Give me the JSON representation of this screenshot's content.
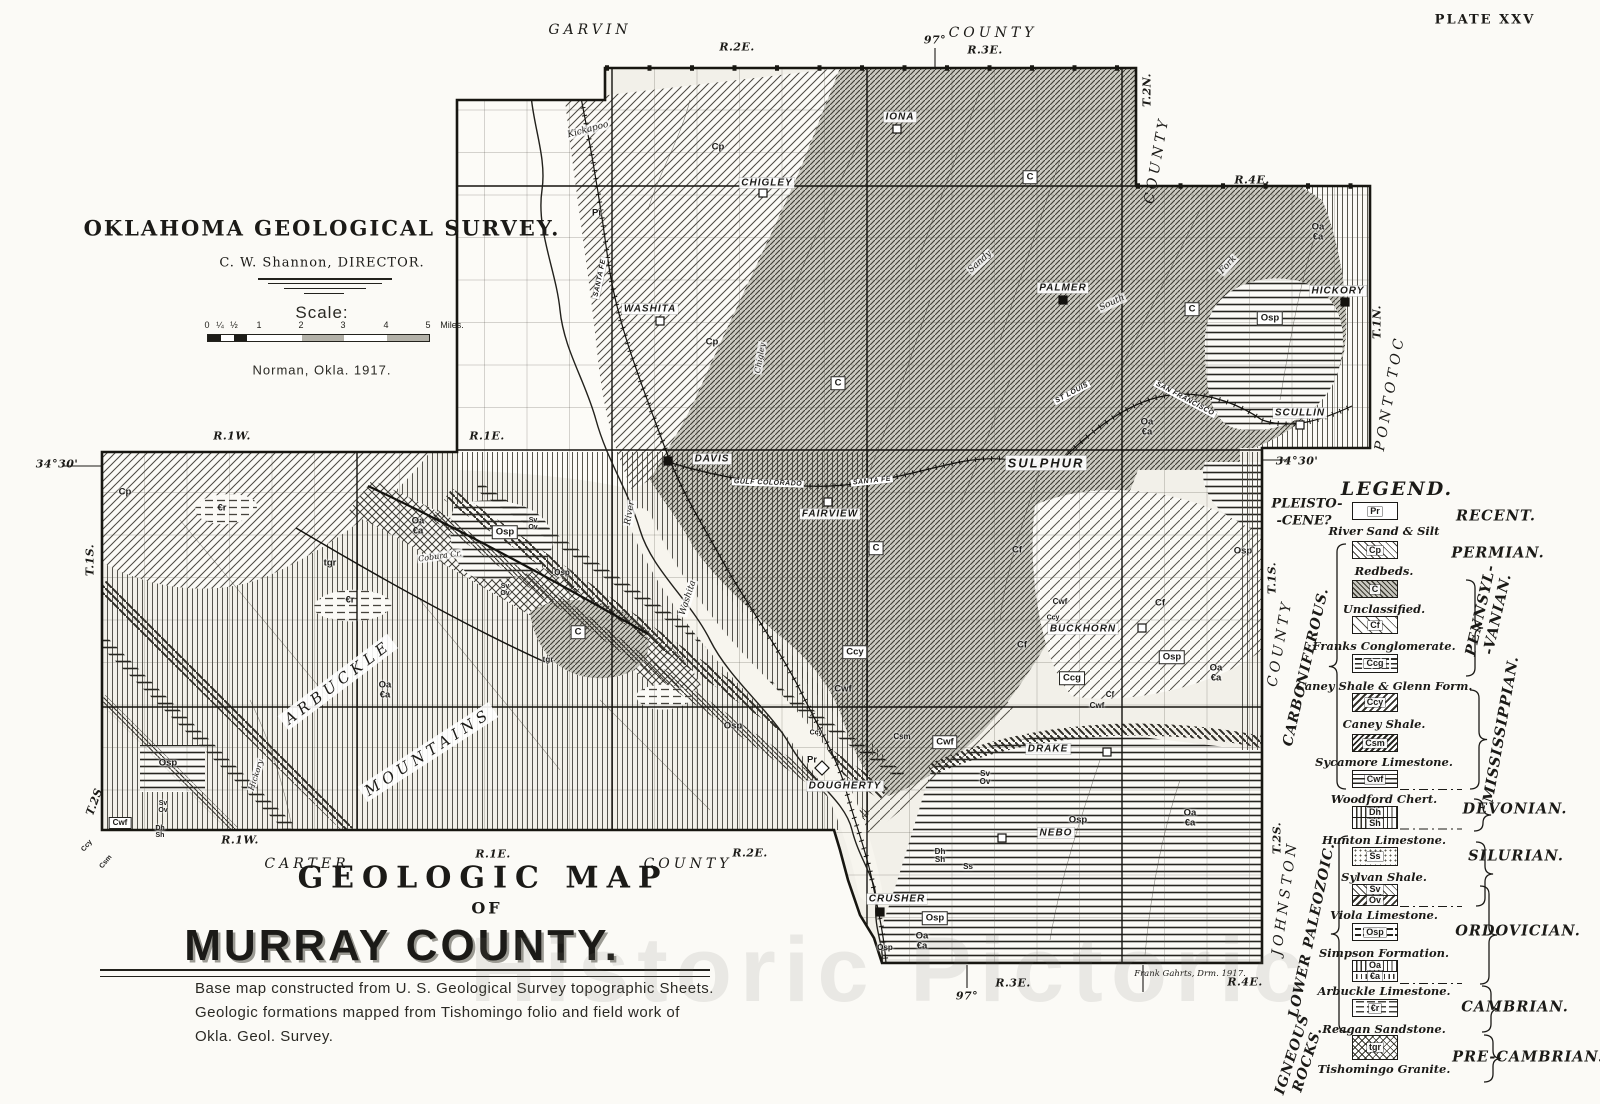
{
  "plate": "PLATE XXV",
  "header": {
    "agency": "OKLAHOMA GEOLOGICAL SURVEY.",
    "director": "C. W. Shannon, DIRECTOR.",
    "scale_label": "Scale:",
    "scale_ticks": [
      "0",
      "¼",
      "½",
      "1",
      "2",
      "3",
      "4",
      "5"
    ],
    "scale_unit": "Miles.",
    "place_date": "Norman, Okla. 1917."
  },
  "footer": {
    "title_line1": "GEOLOGIC MAP",
    "title_line2": "OF",
    "title_line3": "MURRAY COUNTY.",
    "caption_line1": "Base map constructed from U. S. Geological Survey topographic Sheets.",
    "caption_line2": "Geologic formations mapped from Tishomingo folio and field work of",
    "caption_line3": "Okla. Geol. Survey.",
    "credit": "Frank Gahrts, Drm. 1917."
  },
  "watermark": "Historic Pictoric",
  "legend": {
    "title": "LEGEND.",
    "era_left": [
      "PLEISTO-",
      "-CENE?"
    ],
    "rows": [
      {
        "codes": [
          "Pr"
        ],
        "pattern": [
          "blank"
        ],
        "name": "River Sand & Silt",
        "y": 502,
        "h": 18,
        "ny": 531
      },
      {
        "codes": [
          "Cp"
        ],
        "pattern": [
          "diag"
        ],
        "name": "Redbeds.",
        "y": 541,
        "h": 18,
        "ny": 571
      },
      {
        "codes": [
          "C"
        ],
        "pattern": [
          "diagdark"
        ],
        "name": "Unclassified.",
        "y": 580,
        "h": 18,
        "ny": 609
      },
      {
        "codes": [
          "Cf"
        ],
        "pattern": [
          "diagsparse"
        ],
        "name": "Franks Conglomerate.",
        "y": 616,
        "h": 18,
        "ny": 646
      },
      {
        "codes": [
          "Ccg"
        ],
        "pattern": [
          "brick"
        ],
        "name": "Caney Shale & Glenn Form.",
        "y": 654,
        "h": 19,
        "ny": 686
      },
      {
        "codes": [
          "Ccy"
        ],
        "pattern": [
          "chevron"
        ],
        "name": "Caney Shale.",
        "y": 693,
        "h": 19,
        "ny": 724
      },
      {
        "codes": [
          "Csm"
        ],
        "pattern": [
          "diag2"
        ],
        "name": "Sycamore Limestone.",
        "y": 734,
        "h": 18,
        "ny": 762
      },
      {
        "codes": [
          "Cwf"
        ],
        "pattern": [
          "horiz"
        ],
        "name": "Woodford Chert.",
        "y": 770,
        "h": 18,
        "ny": 799
      },
      {
        "codes": [
          "Dh",
          "Sh"
        ],
        "pattern": [
          "vert",
          "vert"
        ],
        "name": "Hunton Limestone.",
        "y": 806,
        "h": 23,
        "ny": 840
      },
      {
        "codes": [
          "Ss"
        ],
        "pattern": [
          "stipple"
        ],
        "name": "Sylvan Shale.",
        "y": 847,
        "h": 19,
        "ny": 877
      },
      {
        "codes": [
          "Sv",
          "Ov"
        ],
        "pattern": [
          "diag",
          "chevron"
        ],
        "name": "Viola Limestone.",
        "y": 884,
        "h": 22,
        "ny": 915
      },
      {
        "codes": [
          "Osp"
        ],
        "pattern": [
          "horizdash"
        ],
        "name": "Simpson Formation.",
        "y": 923,
        "h": 18,
        "ny": 953
      },
      {
        "codes": [
          "Oa",
          "€a"
        ],
        "pattern": [
          "vert",
          "vertdash"
        ],
        "name": "Arbuckle Limestone.",
        "y": 960,
        "h": 22,
        "ny": 991
      },
      {
        "codes": [
          "€r"
        ],
        "pattern": [
          "dash"
        ],
        "name": "Reagan Sandstone.",
        "y": 999,
        "h": 18,
        "ny": 1029
      },
      {
        "codes": [
          "tgr"
        ],
        "pattern": [
          "cross"
        ],
        "name": "Tishomingo Granite.",
        "y": 1035,
        "h": 25,
        "ny": 1069
      }
    ],
    "periods": [
      {
        "t": "RECENT.",
        "x": 1496,
        "y": 516
      },
      {
        "t": "PERMIAN.",
        "x": 1498,
        "y": 553
      },
      {
        "t": "PENNSYL-|-VANIAN.",
        "x": 1489,
        "y": 612,
        "r": -77
      },
      {
        "t": "MISSISSIPPIAN.",
        "x": 1501,
        "y": 729,
        "r": -80
      },
      {
        "t": "DEVONIAN.",
        "x": 1515,
        "y": 809
      },
      {
        "t": "SILURIAN.",
        "x": 1516,
        "y": 856
      },
      {
        "t": "ORDOVICIAN.",
        "x": 1518,
        "y": 931
      },
      {
        "t": "CAMBRIAN.",
        "x": 1515,
        "y": 1007
      },
      {
        "t": "PRE-CAMBRIAN.",
        "x": 1528,
        "y": 1057
      }
    ],
    "groups": [
      {
        "t": "CARBONIFEROUS.",
        "x": 1306,
        "y": 667,
        "r": -77
      },
      {
        "t": "LOWER PALEOZOIC.",
        "x": 1312,
        "y": 930,
        "r": -78
      },
      {
        "t": "IGNEOUS|ROCKS.",
        "x": 1300,
        "y": 1057,
        "r": -72
      }
    ]
  },
  "map": {
    "edge_labels": [
      {
        "t": "R.2E.",
        "x": 737,
        "y": 47
      },
      {
        "t": "97°",
        "x": 935,
        "y": 40
      },
      {
        "t": "R.3E.",
        "x": 985,
        "y": 50
      },
      {
        "t": "T.2N.",
        "x": 1147,
        "y": 90,
        "r": -90
      },
      {
        "t": "R.4E.",
        "x": 1252,
        "y": 180
      },
      {
        "t": "T.1N.",
        "x": 1377,
        "y": 322,
        "r": -90
      },
      {
        "t": "R.1W.",
        "x": 232,
        "y": 436
      },
      {
        "t": "R.1E.",
        "x": 487,
        "y": 436
      },
      {
        "t": "34°30'",
        "x": 57,
        "y": 464
      },
      {
        "t": "34°30'",
        "x": 1297,
        "y": 461
      },
      {
        "t": "T.1S.",
        "x": 90,
        "y": 560,
        "r": -90
      },
      {
        "t": "T.1S.",
        "x": 1272,
        "y": 578,
        "r": -90
      },
      {
        "t": "T.2S.",
        "x": 95,
        "y": 800,
        "r": -70
      },
      {
        "t": "T.2S.",
        "x": 1277,
        "y": 838,
        "r": -90
      },
      {
        "t": "R.1W.",
        "x": 240,
        "y": 840
      },
      {
        "t": "R.1E.",
        "x": 493,
        "y": 854
      },
      {
        "t": "R.2E.",
        "x": 750,
        "y": 853
      },
      {
        "t": "97°",
        "x": 967,
        "y": 996
      },
      {
        "t": "R.3E.",
        "x": 1013,
        "y": 983
      },
      {
        "t": "R.4E.",
        "x": 1245,
        "y": 982
      }
    ],
    "counties": [
      {
        "t": "GARVIN",
        "x": 590,
        "y": 30
      },
      {
        "t": "COUNTY",
        "x": 993,
        "y": 33
      },
      {
        "t": "COUNTY",
        "x": 1157,
        "y": 160,
        "r": -80
      },
      {
        "t": "PONTOTOC",
        "x": 1390,
        "y": 393,
        "r": -80
      },
      {
        "t": "CARTER",
        "x": 307,
        "y": 864
      },
      {
        "t": "COUNTY",
        "x": 688,
        "y": 864
      },
      {
        "t": "COUNTY",
        "x": 1280,
        "y": 643,
        "r": -80
      },
      {
        "t": "JOHNSTON",
        "x": 1285,
        "y": 898,
        "r": -82
      }
    ],
    "towns": [
      {
        "t": "IONA",
        "x": 900,
        "y": 117
      },
      {
        "t": "CHIGLEY",
        "x": 767,
        "y": 183
      },
      {
        "t": "WASHITA",
        "x": 650,
        "y": 309
      },
      {
        "t": "PALMER",
        "x": 1063,
        "y": 288
      },
      {
        "t": "HICKORY",
        "x": 1338,
        "y": 291
      },
      {
        "t": "SCULLIN",
        "x": 1300,
        "y": 413
      },
      {
        "t": "DAVIS",
        "x": 712,
        "y": 459
      },
      {
        "t": "FAIRVIEW",
        "x": 830,
        "y": 514
      },
      {
        "t": "SULPHUR",
        "x": 1046,
        "y": 463,
        "c": "big"
      },
      {
        "t": "BUCKHORN",
        "x": 1083,
        "y": 629
      },
      {
        "t": "DRAKE",
        "x": 1048,
        "y": 749
      },
      {
        "t": "DOUGHERTY",
        "x": 845,
        "y": 786
      },
      {
        "t": "NEBO",
        "x": 1056,
        "y": 833
      },
      {
        "t": "CRUSHER",
        "x": 897,
        "y": 899
      }
    ],
    "codes": [
      {
        "t": "Cp",
        "x": 718,
        "y": 147
      },
      {
        "t": "C",
        "x": 1030,
        "y": 177,
        "b": 1
      },
      {
        "t": "Pr",
        "x": 597,
        "y": 213
      },
      {
        "t": "Cp",
        "x": 712,
        "y": 342
      },
      {
        "t": "C",
        "x": 838,
        "y": 383,
        "b": 1
      },
      {
        "t": "C",
        "x": 1192,
        "y": 309,
        "b": 1
      },
      {
        "t": "Oa|€a",
        "x": 1318,
        "y": 232
      },
      {
        "t": "Osp",
        "x": 1270,
        "y": 318,
        "b": 1
      },
      {
        "t": "Oa|€a",
        "x": 1147,
        "y": 427
      },
      {
        "t": "Cp",
        "x": 125,
        "y": 492
      },
      {
        "t": "€r",
        "x": 222,
        "y": 508
      },
      {
        "t": "Oa|€a",
        "x": 418,
        "y": 526
      },
      {
        "t": "Osp",
        "x": 505,
        "y": 532,
        "b": 1
      },
      {
        "t": "tgr",
        "x": 330,
        "y": 563
      },
      {
        "t": "€r",
        "x": 350,
        "y": 600
      },
      {
        "t": "Sv|Ov",
        "x": 533,
        "y": 524,
        "s": 7
      },
      {
        "t": "Osp",
        "x": 562,
        "y": 573,
        "s": 8
      },
      {
        "t": "Sv|Ov",
        "x": 505,
        "y": 590,
        "s": 7
      },
      {
        "t": "C",
        "x": 578,
        "y": 632,
        "b": 1
      },
      {
        "t": "tgr",
        "x": 548,
        "y": 660,
        "s": 8
      },
      {
        "t": "Oa|€a",
        "x": 385,
        "y": 690
      },
      {
        "t": "Osp",
        "x": 168,
        "y": 763
      },
      {
        "t": "Sv|Ov",
        "x": 163,
        "y": 807,
        "s": 7
      },
      {
        "t": "Cwf",
        "x": 120,
        "y": 823,
        "b": 1,
        "s": 8
      },
      {
        "t": "Dh|Sh",
        "x": 160,
        "y": 832,
        "s": 7
      },
      {
        "t": "Ccy",
        "x": 87,
        "y": 846,
        "r": -50,
        "s": 7
      },
      {
        "t": "Csm",
        "x": 106,
        "y": 862,
        "r": -50,
        "s": 7
      },
      {
        "t": "Ccy",
        "x": 855,
        "y": 652,
        "b": 1
      },
      {
        "t": "Cwf",
        "x": 843,
        "y": 689
      },
      {
        "t": "Osp",
        "x": 733,
        "y": 726
      },
      {
        "t": "Pr",
        "x": 812,
        "y": 760
      },
      {
        "t": "Csm",
        "x": 902,
        "y": 737,
        "s": 8
      },
      {
        "t": "Cwf",
        "x": 945,
        "y": 742,
        "b": 1
      },
      {
        "t": "Ccy",
        "x": 816,
        "y": 733,
        "s": 7
      },
      {
        "t": "Sv|Ov",
        "x": 985,
        "y": 778,
        "s": 8
      },
      {
        "t": "Dh|Sh",
        "x": 940,
        "y": 856,
        "s": 8
      },
      {
        "t": "Ss",
        "x": 968,
        "y": 867,
        "s": 8
      },
      {
        "t": "Osp",
        "x": 1078,
        "y": 820
      },
      {
        "t": "Osp",
        "x": 935,
        "y": 918,
        "b": 1
      },
      {
        "t": "Oa|€a",
        "x": 922,
        "y": 941
      },
      {
        "t": "Osp",
        "x": 885,
        "y": 948,
        "s": 8
      },
      {
        "t": "Oa|€a",
        "x": 1190,
        "y": 818
      },
      {
        "t": "Cf",
        "x": 1017,
        "y": 550
      },
      {
        "t": "C",
        "x": 876,
        "y": 548,
        "b": 1
      },
      {
        "t": "Cf",
        "x": 1160,
        "y": 603
      },
      {
        "t": "Cwf",
        "x": 1060,
        "y": 602,
        "s": 8
      },
      {
        "t": "Ccy",
        "x": 1053,
        "y": 618,
        "s": 7
      },
      {
        "t": "Cf",
        "x": 1022,
        "y": 645
      },
      {
        "t": "Ccg",
        "x": 1072,
        "y": 678,
        "b": 1
      },
      {
        "t": "Cf",
        "x": 1110,
        "y": 695,
        "s": 8
      },
      {
        "t": "Cwf",
        "x": 1097,
        "y": 706,
        "s": 8
      },
      {
        "t": "Osp",
        "x": 1172,
        "y": 657,
        "b": 1
      },
      {
        "t": "Oa|€a",
        "x": 1216,
        "y": 673
      },
      {
        "t": "Osp",
        "x": 1243,
        "y": 551
      }
    ],
    "features": [
      {
        "t": "Kickapoo",
        "x": 588,
        "y": 130,
        "r": -15
      },
      {
        "t": "Sandy",
        "x": 980,
        "y": 262,
        "r": -42
      },
      {
        "t": "Fork",
        "x": 1228,
        "y": 265,
        "r": -48
      },
      {
        "t": "South",
        "x": 1112,
        "y": 303,
        "r": -25
      },
      {
        "t": "Chigley",
        "x": 760,
        "y": 358,
        "r": -80,
        "s": 8
      },
      {
        "t": "Washita",
        "x": 688,
        "y": 598,
        "r": -72
      },
      {
        "t": "River",
        "x": 630,
        "y": 513,
        "r": -80
      },
      {
        "t": "Hickory",
        "x": 256,
        "y": 775,
        "r": -72,
        "s": 8
      },
      {
        "t": "Cobura Cr.",
        "x": 440,
        "y": 556,
        "r": -8,
        "s": 8
      },
      {
        "t": "ARBUCKLE",
        "x": 338,
        "y": 682,
        "r": -37,
        "c": "mtn"
      },
      {
        "t": "MOUNTAINS",
        "x": 428,
        "y": 752,
        "r": -33,
        "c": "mtn"
      }
    ],
    "railroads": [
      {
        "t": "SANTA FE",
        "x": 600,
        "y": 278,
        "r": -78
      },
      {
        "t": "GULF COLORADO",
        "x": 768,
        "y": 483,
        "r": 2
      },
      {
        "t": "SANTA FE",
        "x": 872,
        "y": 481,
        "r": -6
      },
      {
        "t": "ST LOUIS",
        "x": 1072,
        "y": 393,
        "r": -28
      },
      {
        "t": "SAN FRANCISCO",
        "x": 1185,
        "y": 399,
        "r": 28
      }
    ]
  }
}
